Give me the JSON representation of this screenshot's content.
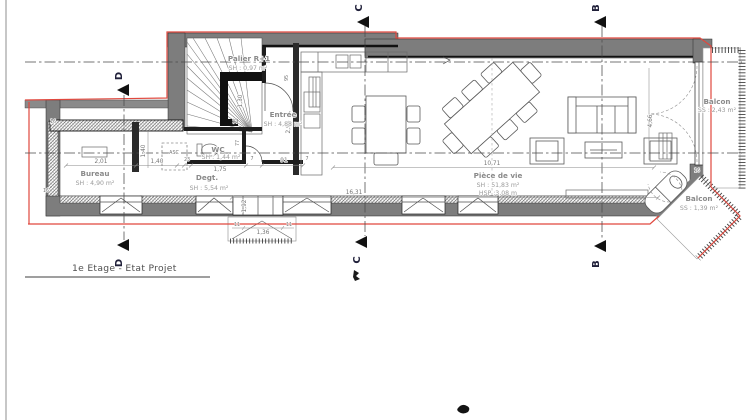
{
  "title": "1e Etage - Etat Projet",
  "sections": {
    "b": "B",
    "c": "C",
    "d": "D"
  },
  "rooms": {
    "palier": {
      "name": "Palier R+1",
      "area": "SH : 0,97 m²"
    },
    "entree": {
      "name": "Entrée",
      "area": "SH : 4,88 m²"
    },
    "wc": {
      "name": "WC",
      "area": "SH : 1,44 m²"
    },
    "bureau": {
      "name": "Bureau",
      "area": "SH : 4,90 m²"
    },
    "degt": {
      "name": "Degt.",
      "area": "SH : 5,54 m²"
    },
    "piece_de_vie": {
      "name": "Pièce de vie",
      "area": "SH : 51,83 m²",
      "height": "HSP :3,08 m"
    },
    "balcon_est": {
      "name": "Balcon",
      "area": "SS : 2,43 m²"
    },
    "balcon_sud": {
      "name": "Balcon",
      "area": "SS : 1,39 m²"
    }
  },
  "labels": {
    "asc": "ASC"
  },
  "dims": {
    "d201": "2,01",
    "d140h": "1,40",
    "d140v": "1,40",
    "d175": "1,75",
    "d23": "23",
    "d91": "91",
    "d7a": "7",
    "d7b": "7",
    "d130": "1,30",
    "d15": "15",
    "d77": "77",
    "d95": "95",
    "d296": "2,96",
    "d192": "1,92",
    "d1631": "16,31",
    "d1071": "10,71",
    "d136": "1,36",
    "d11a": "11",
    "d11b": "11",
    "d466": "4,66",
    "d16a": "16",
    "d16b": "16",
    "d16c": "16"
  },
  "colors": {
    "wall": "#7d7d7d",
    "red_outline": "#e0483e",
    "label_text": "#8a8a8a",
    "dim_text": "#767676"
  }
}
